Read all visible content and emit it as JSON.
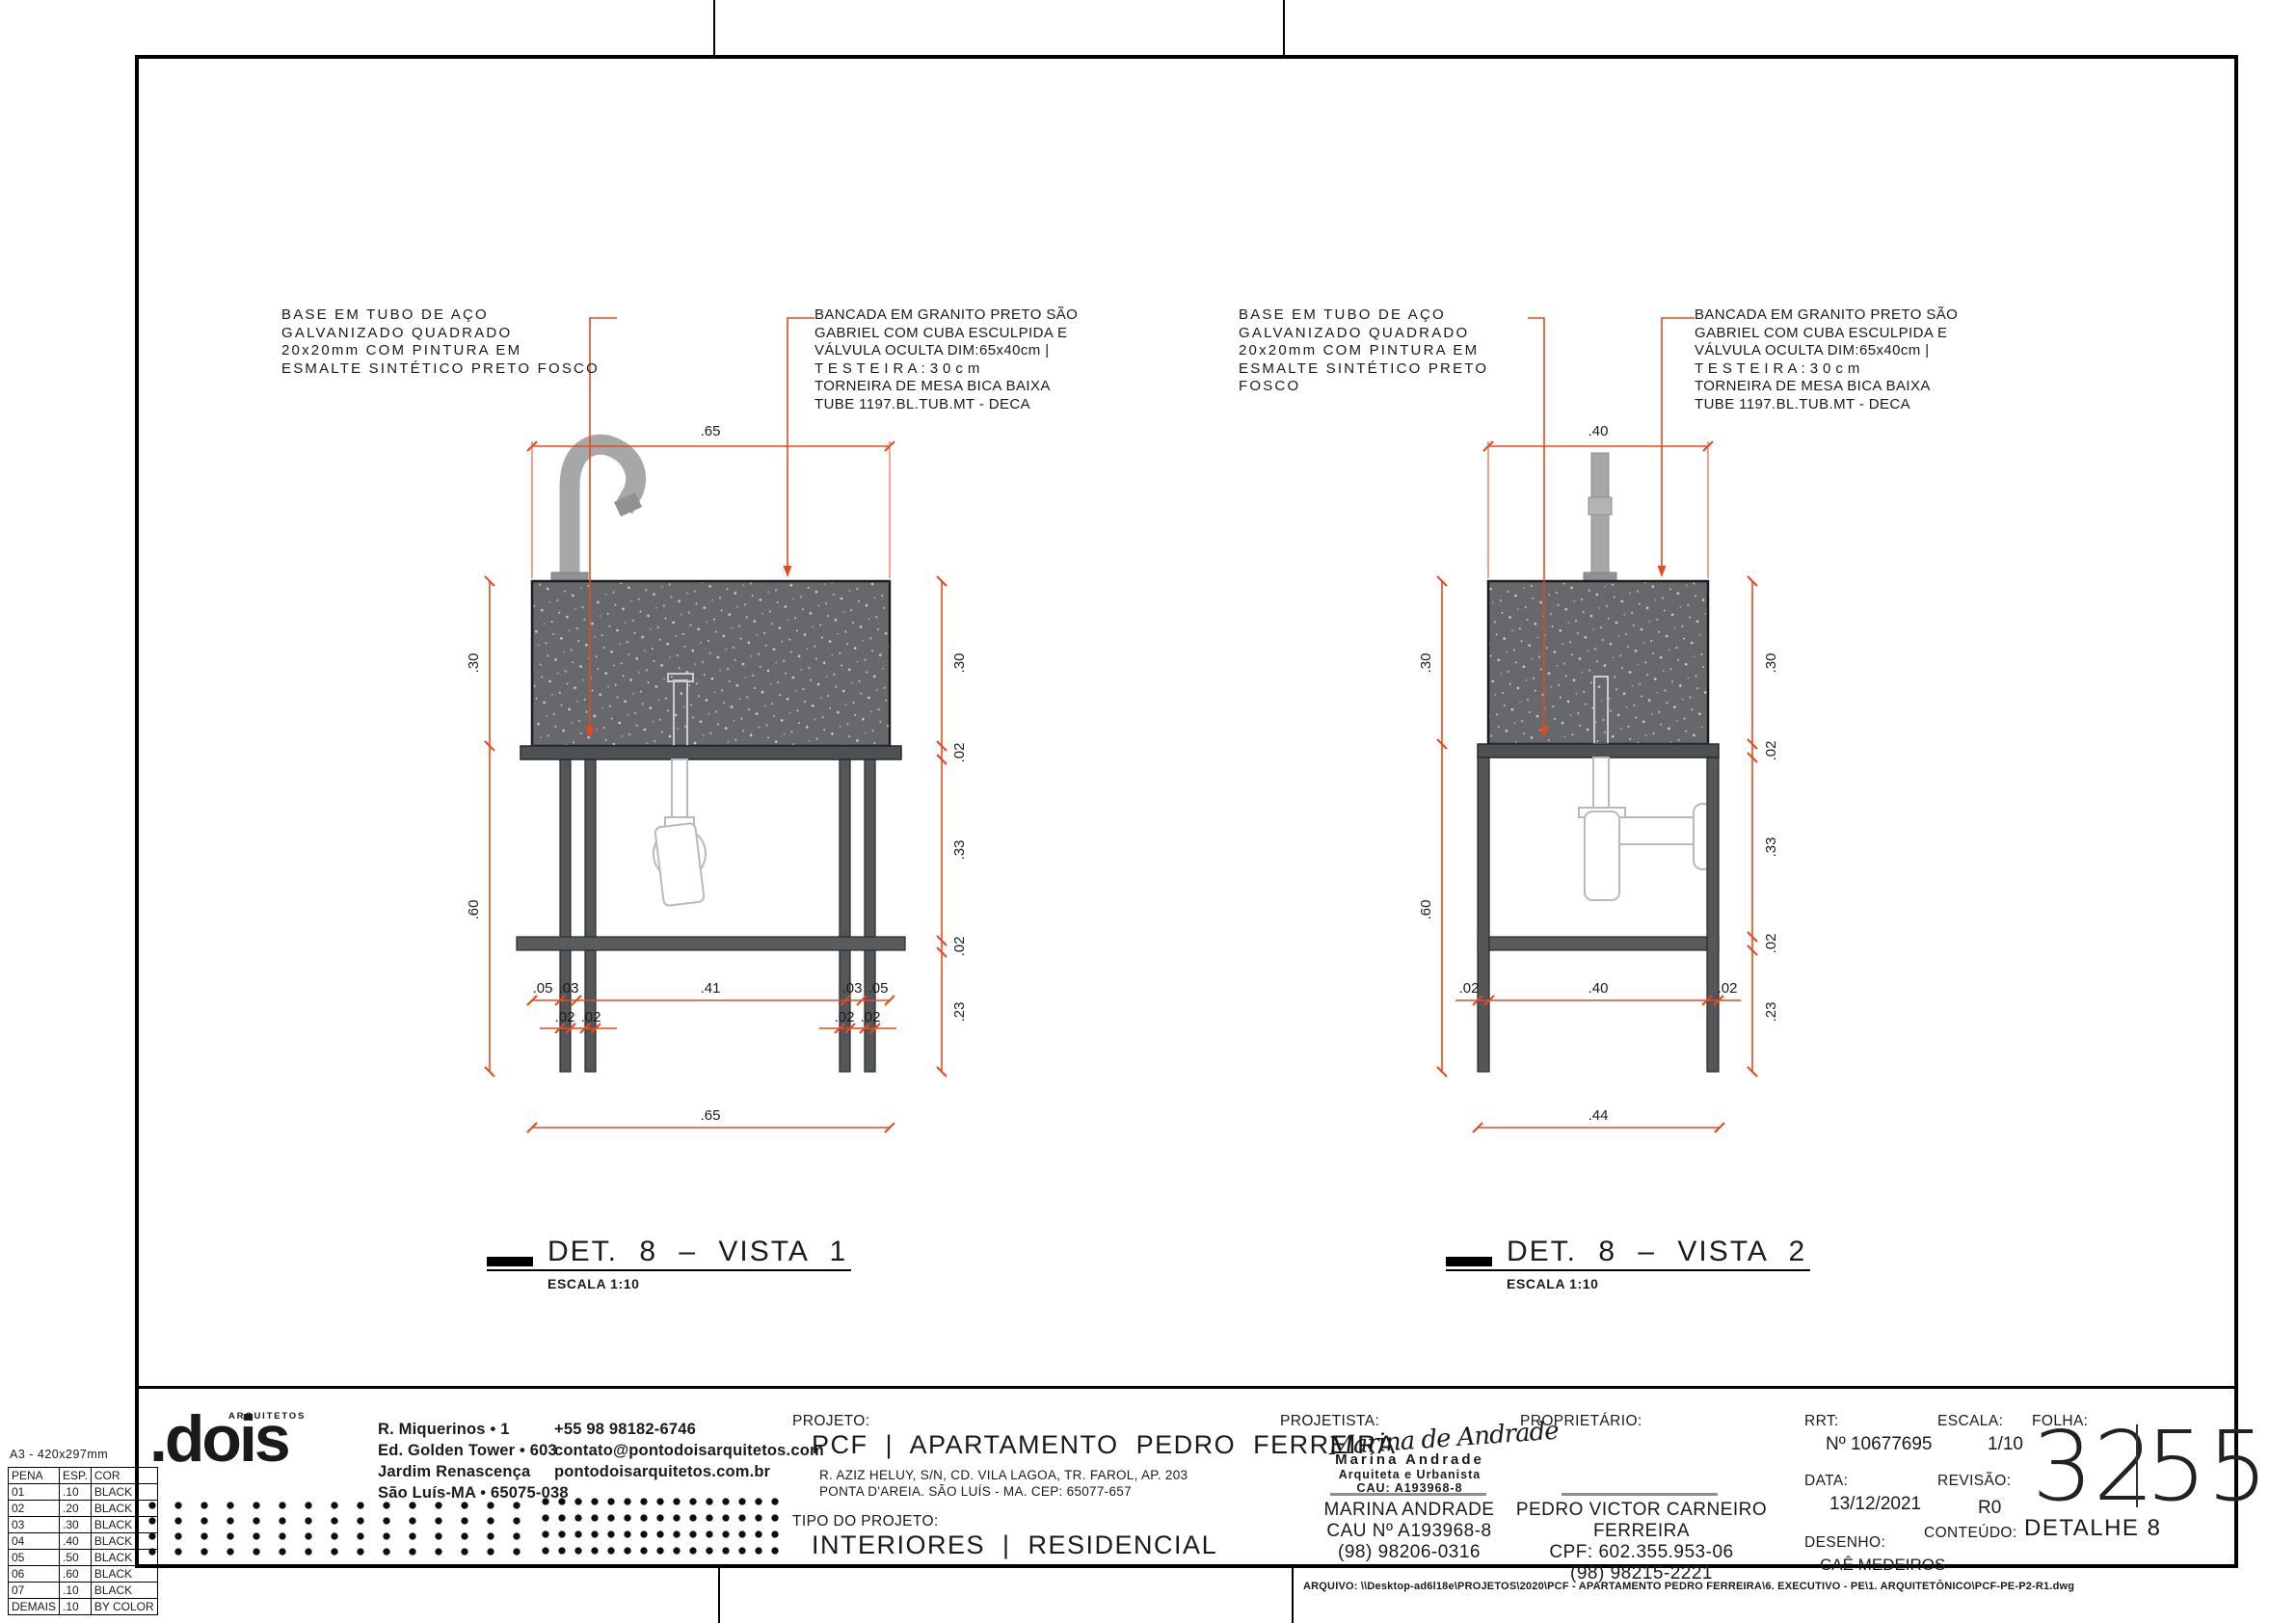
{
  "sheet": {
    "pen_table": {
      "title": "A3 - 420x297mm",
      "headers": [
        "PENA",
        "ESP.",
        "COR"
      ],
      "rows": [
        [
          "01",
          ".10",
          "BLACK"
        ],
        [
          "02",
          ".20",
          "BLACK"
        ],
        [
          "03",
          ".30",
          "BLACK"
        ],
        [
          "04",
          ".40",
          "BLACK"
        ],
        [
          "05",
          ".50",
          "BLACK"
        ],
        [
          "06",
          ".60",
          "BLACK"
        ],
        [
          "07",
          ".10",
          "BLACK"
        ],
        [
          "DEMAIS",
          ".10",
          "BY COLOR"
        ]
      ]
    },
    "arquivo": "ARQUIVO: \\\\Desktop-ad6l18e\\PROJETOS\\2020\\PCF - APARTAMENTO PEDRO FERREIRA\\6. EXECUTIVO - PE\\1. ARQUITETÔNICO\\PCF-PE-P2-R1.dwg"
  },
  "annotations": {
    "base": "BASE EM TUBO DE AÇO\nGALVANIZADO QUADRADO\n20x20mm COM PINTURA EM\nESMALTE SINTÉTICO PRETO FOSCO",
    "bancada": "BANCADA EM GRANITO PRETO SÃO\nGABRIEL COM CUBA ESCULPIDA E\nVÁLVULA OCULTA DIM:65x40cm |\nT E S T E I R A :    3 0 c m\nTORNEIRA DE MESA BICA BAIXA\nTUBE 1197.BL.TUB.MT - DECA"
  },
  "views": {
    "v1": {
      "title": "DET. 8  –  VISTA 1",
      "escala": "ESCALA 1:10",
      "dims": {
        "top": ".65",
        "left_a": ".30",
        "left_b": ".60",
        "r1": ".30",
        "r2": ".02",
        "r3": ".33",
        "r4": ".02",
        "r5": ".23",
        "a1": ".05",
        "a2": ".03",
        "a3": ".41",
        "a4": ".03",
        "a5": ".05",
        "c1": ".02",
        "c2": ".02",
        "c3": ".02",
        "c4": ".02",
        "total": ".65"
      }
    },
    "v2": {
      "title": "DET. 8  –  VISTA 2",
      "escala": "ESCALA 1:10",
      "dims": {
        "top": ".40",
        "left_a": ".30",
        "left_b": ".60",
        "r1": ".30",
        "r2": ".02",
        "r3": ".33",
        "r4": ".02",
        "r5": ".23",
        "a1": ".02",
        "a2": ".40",
        "a3": ".02",
        "total": ".44"
      }
    }
  },
  "titleblock": {
    "logo_name": ".dois",
    "logo_tag": "ARQUITETOS",
    "address": "R. Miquerinos • 1\nEd. Golden Tower • 603\nJardim Renascença\nSão Luís-MA • 65075-038",
    "contacts": "+55 98 98182-6746\ncontato@pontodoisarquitetos.com\npontodoisarquitetos.com.br",
    "projeto_label": "PROJETO:",
    "projeto": "PCF | APARTAMENTO PEDRO FERREIRA",
    "projeto_endereco": "R. AZIZ HELUY, S/N, CD. VILA LAGOA, TR. FAROL, AP. 203\nPONTA D'AREIA. SÃO LUÍS - MA. CEP: 65077-657",
    "tipo_label": "TIPO DO PROJETO:",
    "tipo": "INTERIORES | RESIDENCIAL",
    "projetista_label": "PROJETISTA:",
    "assinatura": "Marina de Andrade",
    "stamp_nome": "Marina Andrade",
    "stamp_titulo": "Arquiteta e Urbanista",
    "stamp_cau": "CAU: A193968-8",
    "projetista_nome": "MARINA ANDRADE",
    "projetista_cau": "CAU Nº A193968-8",
    "projetista_fone": "(98) 98206-0316",
    "proprietario_label": "PROPRIETÁRIO:",
    "proprietario_nome": "PEDRO VICTOR CARNEIRO FERREIRA",
    "proprietario_cpf": "CPF: 602.355.953-06",
    "proprietario_fone": "(98) 98215-2221",
    "rrt_label": "RRT:",
    "rrt": "Nº 10677695",
    "data_label": "DATA:",
    "data": "13/12/2021",
    "desenho_label": "DESENHO:",
    "desenho": "CAÊ MEDEIROS",
    "escala_label": "ESCALA:",
    "escala": "1/10",
    "revisao_label": "REVISÃO:",
    "revisao": "R0",
    "conteudo_label": "CONTEÚDO:",
    "conteudo": "DETALHE 8",
    "folha_label": "FOLHA:",
    "folha_num": "32",
    "folha_total": "55"
  },
  "colors": {
    "dim_line": "#e8491c",
    "granito": "#66686b",
    "estrutura": "#54575a"
  }
}
